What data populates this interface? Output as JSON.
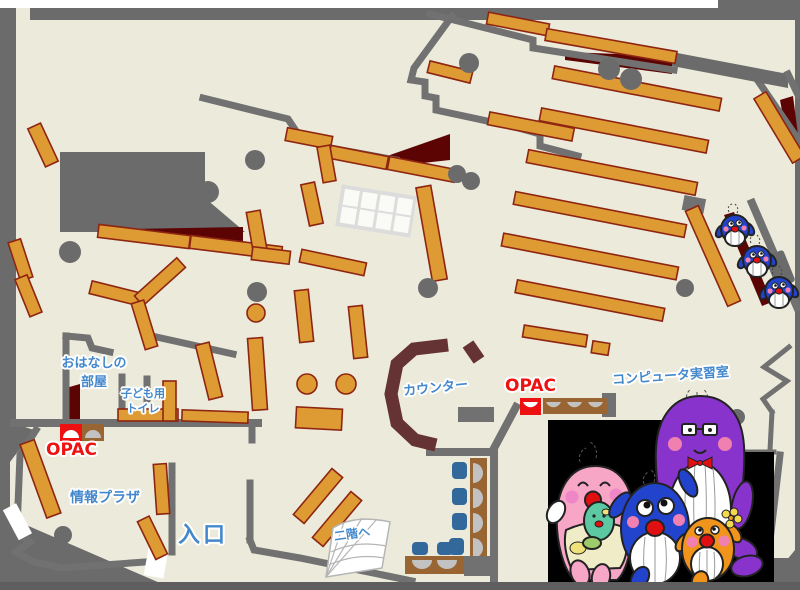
{
  "title": "library-floor-map",
  "labels": {
    "storytelling_room_l1": "おはなしの",
    "storytelling_room_l2": "部屋",
    "kids_toilet_l1": "子ども用",
    "kids_toilet_l2": "トイレ",
    "opac": "OPAC",
    "info_plaza": "情報プラザ",
    "entrance": "入口",
    "counter": "カウンター",
    "computer_room": "コンピュータ実習室",
    "to_second_floor": "二階へ"
  },
  "colors": {
    "bg": "#6b6b6b",
    "floor": "#ecebdb",
    "wall": "#717171",
    "band_dark": "#5e5e5e",
    "shelf": "#de9a33",
    "shelf_border": "#8e2512",
    "shadow": "#5c0404",
    "counter": "#663334",
    "pillar": "#6b6b6b",
    "table_gray": "#dcdcdc",
    "cell_white": "#fafaf6",
    "door_white": "#ffffff",
    "label_blue": "#4488cc",
    "opac_red": "#ee1111",
    "chair_blue": "#33689b",
    "desk_brown": "#996633",
    "monitor_gray": "#c2c2c2",
    "stairs_line": "#b5b5b5",
    "panel_black": "#000000",
    "mascot_purple": "#8833cc",
    "mascot_pink": "#f7a6c6",
    "mascot_blue": "#2244cc",
    "mascot_orange": "#f0941c",
    "mascot_teal": "#5cc9a2",
    "apron_cream": "#f0ecc8",
    "cheek_pink": "#f080b0",
    "mouth_red": "#e01010",
    "outline_dark": "#222222"
  }
}
